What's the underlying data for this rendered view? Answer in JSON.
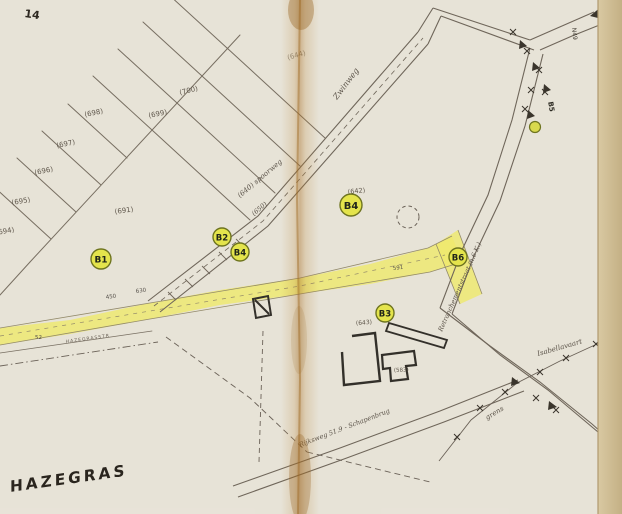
{
  "page": {
    "description": "Scanned cadastral map of the Hazegras area with yellow-highlighted road corridor and numbered B-markers",
    "corner_mark": "14"
  },
  "area_label": {
    "text": "HAZEGRAS"
  },
  "markers": [
    {
      "id": "B1",
      "label": "B1"
    },
    {
      "id": "B2",
      "label": "B2"
    },
    {
      "id": "B4a",
      "label": "B4"
    },
    {
      "id": "B4",
      "label": "B4"
    },
    {
      "id": "B3",
      "label": "B3"
    },
    {
      "id": "B6",
      "label": "B6"
    },
    {
      "id": "B5",
      "label": "B5"
    }
  ],
  "parcels": [
    "(700)",
    "(699)",
    "(698)",
    "(697)",
    "(696)",
    "(695)",
    "(694)",
    "(691)",
    "(644)",
    "(642)",
    "(643)",
    "(583)"
  ],
  "roads": {
    "zwinweg": "Zwinweg",
    "tram": "(640) spoorweg",
    "tram2": "(650)",
    "hazegrasstraat": "HAZEGRASSTR",
    "retranchement": "Retranchementstraat (n.6 K.)",
    "bottom_road": "Rijksweg 51.9 - Schapenbrug",
    "isabellavaart": "Isabellavaart",
    "grens": "grens",
    "route_number": "N49"
  },
  "measurements": [
    "450",
    "630",
    "591",
    "52"
  ],
  "colors": {
    "paper": "#eae6dd",
    "page_edge": "#d5c49c",
    "fold_stain": "#b98338",
    "ink": "#6f665a",
    "dark_ink": "#33302a",
    "highlight_yellow": "#efe96b",
    "marker_fill": "#e4e44c",
    "marker_stroke": "#6e741f"
  }
}
